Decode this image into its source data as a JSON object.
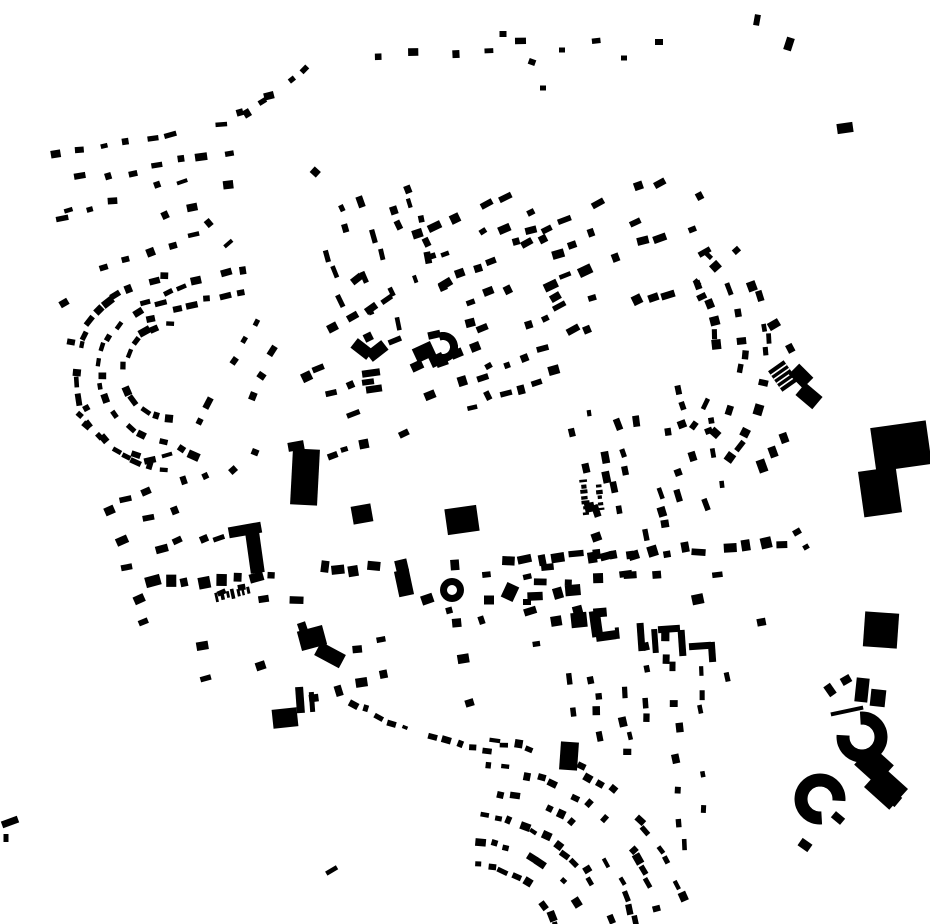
{
  "map": {
    "kind": "figure-ground-building-footprint-map",
    "width": 930,
    "height": 924,
    "ink": "#000000",
    "background": "#ffffff",
    "seed": 11,
    "grids": [
      {
        "x": 150,
        "y": 172,
        "w": 180,
        "h": 70,
        "rot": -10,
        "rg": 30,
        "cg": 24,
        "bw": 9,
        "bh": 6,
        "d": 0.55
      },
      {
        "x": 142,
        "y": 228,
        "w": 140,
        "h": 70,
        "rot": -18,
        "rg": 30,
        "cg": 24,
        "bw": 9,
        "bh": 6,
        "d": 0.45
      },
      {
        "x": 268,
        "y": 205,
        "w": 150,
        "h": 110,
        "rot": -42,
        "rg": 30,
        "cg": 22,
        "bw": 9,
        "bh": 6,
        "d": 0.38,
        "el": 1
      },
      {
        "x": 255,
        "y": 385,
        "w": 170,
        "h": 120,
        "rot": -62,
        "rg": 30,
        "cg": 24,
        "bw": 9,
        "bh": 6,
        "d": 0.42,
        "el": 1
      },
      {
        "x": 383,
        "y": 245,
        "w": 165,
        "h": 130,
        "rot": 72,
        "rg": 24,
        "cg": 18,
        "bw": 10,
        "bh": 6,
        "d": 0.5,
        "el": 1
      },
      {
        "x": 492,
        "y": 258,
        "w": 150,
        "h": 160,
        "rot": -25,
        "rg": 28,
        "cg": 19,
        "bw": 10,
        "bh": 7,
        "d": 0.55,
        "el": 1
      },
      {
        "x": 612,
        "y": 252,
        "w": 235,
        "h": 155,
        "rot": -22,
        "rg": 27,
        "cg": 17,
        "bw": 10,
        "bh": 7,
        "d": 0.6,
        "cv": 10,
        "el": 1
      },
      {
        "x": 408,
        "y": 398,
        "w": 185,
        "h": 110,
        "rot": -18,
        "rg": 28,
        "cg": 19,
        "bw": 10,
        "bh": 7,
        "d": 0.5
      },
      {
        "x": 514,
        "y": 372,
        "w": 110,
        "h": 80,
        "rot": -22,
        "rg": 28,
        "cg": 18,
        "bw": 9,
        "bh": 7,
        "d": 0.45,
        "el": 1
      },
      {
        "x": 652,
        "y": 460,
        "w": 150,
        "h": 170,
        "rot": 76,
        "rg": 22,
        "cg": 16,
        "bw": 9,
        "bh": 6,
        "d": 0.5,
        "el": 1
      },
      {
        "x": 182,
        "y": 552,
        "w": 115,
        "h": 140,
        "rot": -18,
        "rg": 30,
        "cg": 20,
        "bw": 9,
        "bh": 7,
        "d": 0.55,
        "cv": 8
      },
      {
        "x": 262,
        "y": 662,
        "w": 220,
        "h": 130,
        "rot": -12,
        "rg": 36,
        "cg": 26,
        "bw": 11,
        "bh": 8,
        "d": 0.26,
        "el": 1
      },
      {
        "x": 455,
        "y": 640,
        "w": 200,
        "h": 90,
        "rot": -12,
        "rg": 32,
        "cg": 26,
        "bw": 9,
        "bh": 7,
        "d": 0.45
      },
      {
        "x": 430,
        "y": 706,
        "w": 140,
        "h": 60,
        "rot": -12,
        "rg": 34,
        "cg": 28,
        "bw": 9,
        "bh": 7,
        "d": 0.15
      },
      {
        "x": 645,
        "y": 688,
        "w": 150,
        "h": 160,
        "rot": 84,
        "rg": 26,
        "cg": 15,
        "bw": 9,
        "bh": 6,
        "d": 0.55,
        "el": 1
      },
      {
        "x": 600,
        "y": 588,
        "w": 130,
        "h": 60,
        "rot": -10,
        "rg": 26,
        "cg": 20,
        "bw": 12,
        "bh": 9,
        "d": 0.5
      },
      {
        "x": 733,
        "y": 600,
        "w": 85,
        "h": 95,
        "rot": 78,
        "rg": 28,
        "cg": 18,
        "bw": 8,
        "bh": 9,
        "d": 0.4,
        "el": 1
      },
      {
        "x": 747,
        "y": 505,
        "w": 90,
        "h": 55,
        "rot": 75,
        "rg": 30,
        "cg": 20,
        "bw": 7,
        "bh": 9,
        "d": 0.35,
        "el": 1
      },
      {
        "x": 768,
        "y": 358,
        "w": 95,
        "h": 95,
        "rot": -32,
        "rg": 26,
        "cg": 18,
        "bw": 9,
        "bh": 8,
        "d": 0.45,
        "el": 1
      },
      {
        "x": 690,
        "y": 800,
        "w": 110,
        "h": 70,
        "rot": 85,
        "rg": 24,
        "cg": 16,
        "bw": 9,
        "bh": 6,
        "d": 0.5,
        "el": 1
      },
      {
        "x": 352,
        "y": 300,
        "w": 95,
        "h": 85,
        "rot": -30,
        "rg": 28,
        "cg": 20,
        "bw": 9,
        "bh": 7,
        "d": 0.35,
        "el": 1
      },
      {
        "x": 500,
        "y": 600,
        "w": 100,
        "h": 50,
        "rot": -10,
        "rg": 28,
        "cg": 22,
        "bw": 9,
        "bh": 7,
        "d": 0.3
      },
      {
        "x": 600,
        "y": 520,
        "w": 100,
        "h": 80,
        "rot": -18,
        "rg": 28,
        "cg": 20,
        "bw": 9,
        "bh": 7,
        "d": 0.4,
        "el": 1
      },
      {
        "x": 372,
        "y": 868,
        "w": 135,
        "h": 95,
        "rot": -25,
        "rg": 34,
        "cg": 26,
        "bw": 9,
        "bh": 7,
        "d": 0.3,
        "el": 1
      },
      {
        "x": 835,
        "y": 690,
        "w": 70,
        "h": 45,
        "rot": -28,
        "rg": 24,
        "cg": 18,
        "bw": 8,
        "bh": 6,
        "d": 0.3,
        "el": 1
      }
    ],
    "rings": [
      {
        "x": 172,
        "y": 372,
        "radii": [
          48,
          72,
          96
        ],
        "a0": 95,
        "a1": 268,
        "step": 13,
        "bw": 9,
        "bh": 6,
        "d": 0.8
      },
      {
        "x": 470,
        "y": 960,
        "radii": [
          95,
          120,
          145,
          170,
          195,
          220
        ],
        "a0": 276,
        "a1": 347,
        "step": 13,
        "bw": 8,
        "bh": 6,
        "d": 0.72
      },
      {
        "x": 600,
        "y": 350,
        "radii": [
          118,
          143,
          168
        ],
        "a0": -42,
        "a1": 42,
        "step": 14,
        "bw": 9,
        "bh": 7,
        "d": 0.6
      }
    ],
    "lines": [
      {
        "pts": [
          [
            78,
            415
          ],
          [
            108,
            444
          ],
          [
            148,
            459
          ],
          [
            183,
            450
          ],
          [
            207,
            463
          ],
          [
            232,
            470
          ],
          [
            258,
            452
          ]
        ],
        "step": 13,
        "bw": 9,
        "bh": 6,
        "d": 0.9
      },
      {
        "pts": [
          [
            168,
            292
          ],
          [
            225,
            272
          ],
          [
            288,
            262
          ]
        ],
        "step": 14,
        "bw": 9,
        "bh": 6,
        "d": 0.85
      },
      {
        "pts": [
          [
            152,
            318
          ],
          [
            206,
            300
          ],
          [
            260,
            291
          ]
        ],
        "step": 14,
        "bw": 9,
        "bh": 6,
        "d": 0.85
      },
      {
        "pts": [
          [
            235,
            108
          ],
          [
            305,
            84
          ],
          [
            380,
            60
          ],
          [
            455,
            50
          ],
          [
            525,
            44
          ],
          [
            595,
            44
          ],
          [
            658,
            40
          ]
        ],
        "step": 32,
        "bw": 9,
        "bh": 6,
        "d": 0.5,
        "jit": 10
      },
      {
        "pts": [
          [
            232,
            126
          ],
          [
            262,
            103
          ],
          [
            293,
            80
          ],
          [
            318,
            60
          ]
        ],
        "step": 15,
        "bw": 9,
        "bh": 6,
        "d": 0.85
      },
      {
        "pts": [
          [
            152,
            584
          ],
          [
            290,
            572
          ],
          [
            420,
            564
          ],
          [
            560,
            557
          ],
          [
            700,
            549
          ],
          [
            798,
            544
          ]
        ],
        "step": 16,
        "bw": 11,
        "bh": 9,
        "d": 0.8,
        "jit": 7,
        "aj": 22
      },
      {
        "pts": [
          [
            185,
            606
          ],
          [
            320,
            594
          ],
          [
            460,
            585
          ],
          [
            600,
            577
          ],
          [
            720,
            570
          ]
        ],
        "step": 24,
        "bw": 10,
        "bh": 8,
        "d": 0.5,
        "jit": 8
      },
      {
        "pts": [
          [
            352,
            704
          ],
          [
            392,
            722
          ],
          [
            432,
            738
          ],
          [
            472,
            749
          ],
          [
            502,
            753
          ]
        ],
        "step": 12,
        "bw": 7,
        "bh": 5,
        "d": 0.9
      },
      {
        "pts": [
          [
            217,
            597
          ],
          [
            254,
            589
          ]
        ],
        "step": 5,
        "bw": 3,
        "bh": 8,
        "d": 1,
        "aj": 0,
        "jit": 1
      },
      {
        "pts": [
          [
            583,
            481
          ],
          [
            587,
            519
          ]
        ],
        "step": 5,
        "bw": 3,
        "bh": 6,
        "d": 1,
        "aj": 0,
        "jit": 1
      },
      {
        "pts": [
          [
            599,
            486
          ],
          [
            602,
            515
          ]
        ],
        "step": 5,
        "bw": 3,
        "bh": 6,
        "d": 1,
        "aj": 0,
        "jit": 1
      }
    ],
    "buildings": [
      [
        305,
        477,
        27,
        56,
        3
      ],
      [
        296,
        446,
        16,
        9,
        -10
      ],
      [
        245,
        530,
        33,
        11,
        -10
      ],
      [
        255,
        553,
        14,
        40,
        -8
      ],
      [
        362,
        514,
        20,
        18,
        -10
      ],
      [
        462,
        520,
        32,
        26,
        -8
      ],
      [
        569,
        756,
        18,
        28,
        4
      ],
      [
        362,
        349,
        20,
        12,
        38
      ],
      [
        377,
        351,
        20,
        12,
        -38
      ],
      [
        371,
        373,
        18,
        7,
        -8
      ],
      [
        368,
        382,
        12,
        6,
        -8
      ],
      [
        374,
        389,
        16,
        7,
        -8
      ],
      [
        424,
        352,
        20,
        15,
        -25
      ],
      [
        437,
        360,
        14,
        11,
        -25
      ],
      [
        417,
        366,
        12,
        9,
        -25
      ],
      [
        312,
        638,
        26,
        20,
        -15
      ],
      [
        330,
        655,
        28,
        15,
        28
      ],
      [
        285,
        718,
        25,
        19,
        -6
      ],
      [
        579,
        620,
        16,
        15,
        -6
      ],
      [
        596,
        624,
        11,
        26,
        -8
      ],
      [
        606,
        636,
        20,
        9,
        -8
      ],
      [
        641,
        637,
        7,
        28,
        -4
      ],
      [
        655,
        641,
        6,
        24,
        -4
      ],
      [
        669,
        629,
        22,
        7,
        -4
      ],
      [
        682,
        643,
        7,
        26,
        -4
      ],
      [
        700,
        646,
        22,
        7,
        -4
      ],
      [
        712,
        652,
        7,
        20,
        -4
      ],
      [
        881,
        630,
        34,
        35,
        4
      ],
      [
        901,
        446,
        56,
        44,
        -8
      ],
      [
        880,
        492,
        38,
        46,
        -8
      ],
      [
        783,
        376,
        19,
        25,
        -35,
        "striped"
      ],
      [
        801,
        376,
        20,
        15,
        45
      ],
      [
        809,
        396,
        22,
        16,
        40
      ],
      [
        404,
        583,
        15,
        26,
        -12
      ],
      [
        489,
        600,
        10,
        9,
        0
      ],
      [
        510,
        592,
        13,
        16,
        25
      ],
      [
        527,
        602,
        8,
        6,
        0
      ],
      [
        845,
        128,
        16,
        10,
        -8
      ],
      [
        10,
        822,
        17,
        7,
        -20
      ],
      [
        6,
        838,
        5,
        8,
        0
      ],
      [
        762,
        466,
        9,
        13,
        -20
      ],
      [
        773,
        452,
        8,
        11,
        -20
      ],
      [
        784,
        438,
        8,
        10,
        -20
      ],
      [
        797,
        532,
        8,
        6,
        -30
      ],
      [
        806,
        547,
        6,
        5,
        -30
      ],
      [
        300,
        700,
        8,
        26,
        -4
      ],
      [
        312,
        702,
        5,
        20,
        -4
      ],
      [
        64,
        303,
        9,
        7,
        -30
      ],
      [
        71,
        342,
        8,
        6,
        10
      ],
      [
        503,
        34,
        7,
        6,
        0
      ],
      [
        532,
        62,
        7,
        6,
        20
      ],
      [
        543,
        88,
        6,
        5,
        0
      ],
      [
        562,
        50,
        6,
        5,
        0
      ],
      [
        624,
        58,
        6,
        5,
        0
      ],
      [
        659,
        42,
        8,
        6,
        0
      ],
      [
        757,
        20,
        6,
        11,
        10
      ],
      [
        789,
        44,
        8,
        13,
        18
      ],
      [
        862,
        690,
        13,
        24,
        6
      ],
      [
        878,
        698,
        15,
        17,
        6
      ],
      [
        846,
        680,
        10,
        8,
        -30
      ],
      [
        830,
        690,
        8,
        12,
        -35
      ],
      [
        847,
        711,
        33,
        4,
        -12
      ],
      [
        874,
        765,
        30,
        26,
        42
      ],
      [
        886,
        788,
        34,
        28,
        42
      ],
      [
        893,
        798,
        14,
        12,
        40
      ],
      [
        838,
        818,
        12,
        8,
        40
      ],
      [
        805,
        845,
        12,
        9,
        35
      ]
    ],
    "arcs": [
      {
        "x": 862,
        "y": 737,
        "r": 19,
        "w": 13,
        "a0": 265,
        "a1": 545
      },
      {
        "x": 820,
        "y": 799,
        "r": 19,
        "w": 13,
        "a0": 85,
        "a1": 365
      },
      {
        "x": 443,
        "y": 347,
        "r": 11,
        "w": 8,
        "a0": -110,
        "a1": 110
      }
    ],
    "donuts": [
      {
        "x": 452,
        "y": 590,
        "r": 12,
        "hole": 5
      }
    ]
  }
}
